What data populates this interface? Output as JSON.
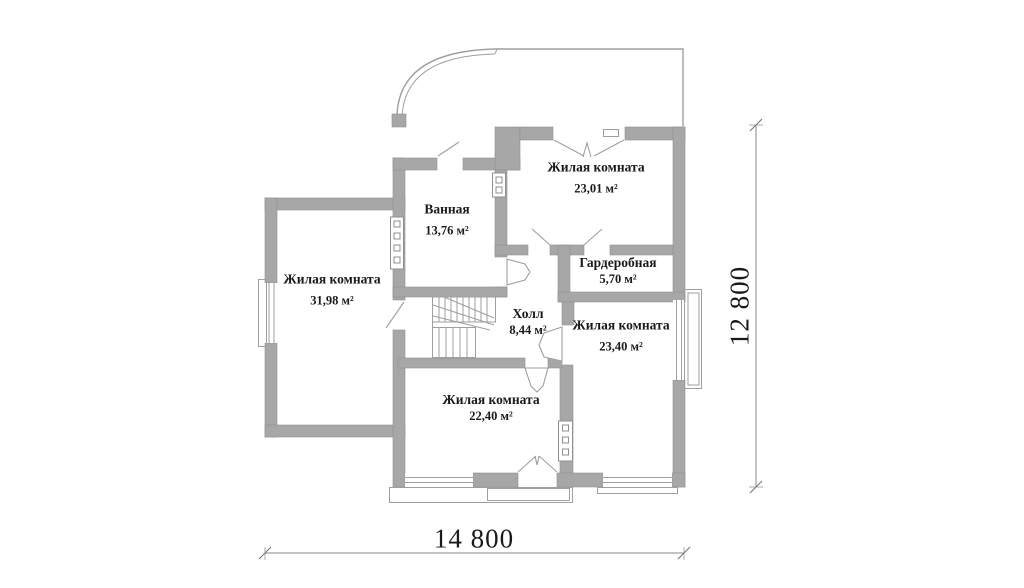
{
  "rooms": [
    {
      "id": "living-2301",
      "name": "Жилая комната",
      "area": "23,01 м²"
    },
    {
      "id": "bathroom",
      "name": "Ванная",
      "area": "13,76 м²"
    },
    {
      "id": "living-3198",
      "name": "Жилая комната",
      "area": "31,98 м²"
    },
    {
      "id": "wardrobe",
      "name": "Гардеробная",
      "area": "5,70 м²"
    },
    {
      "id": "hall",
      "name": "Холл",
      "area": "8,44 м²"
    },
    {
      "id": "living-2340",
      "name": "Жилая комната",
      "area": "23,40 м²"
    },
    {
      "id": "living-2240",
      "name": "Жилая комната",
      "area": "22,40 м²"
    }
  ],
  "dimensions": {
    "width_label": "14 800",
    "height_label": "12 800"
  },
  "colors": {
    "wall": "#a7a7a7",
    "wall_edge": "#8f8f8f",
    "thin": "#9f9f9f",
    "text": "#1a1a1a",
    "background": "#ffffff"
  }
}
